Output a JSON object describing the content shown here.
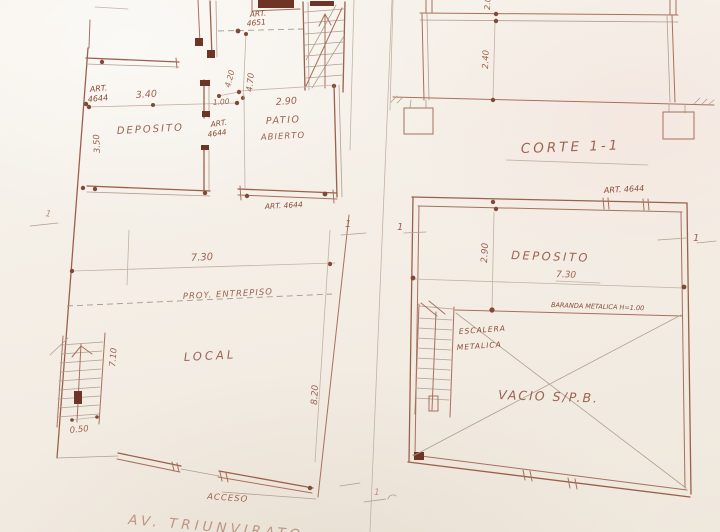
{
  "plan_left": {
    "labels": {
      "art4651_1": "ART.",
      "art4651_2": "4651",
      "art4644a_1": "ART.",
      "art4644a_2": "4644",
      "art4644b_1": "ART.",
      "art4644b_2": "4644",
      "art4644c": "ART. 4644",
      "deposito": "DEPOSITO",
      "patio1": "PATIO",
      "patio2": "ABIERTO",
      "proy": "PROY. ENTREPISO",
      "local": "LOCAL",
      "acceso": "ACCESO",
      "street": "AV. TRIUNVIRATO"
    },
    "dims": {
      "w_deposito": "3.40",
      "h_deposito": "3.50",
      "door": "1.00",
      "w_patio": "2.90",
      "h_patio": "4.70",
      "h_patio2": "4.20",
      "w_planta": "7.30",
      "h_local": "8.20",
      "h_escalera": "7.10",
      "w_escalera": "0.50"
    }
  },
  "section": {
    "title": "CORTE 1-1",
    "h_interior": "2.40",
    "h_top": "2.0"
  },
  "plan_right": {
    "labels": {
      "art4644": "ART. 4644",
      "deposito": "DEPOSITO",
      "baranda": "BARANDA METALICA H=1.00",
      "escalera1": "ESCALERA",
      "escalera2": "METALICA",
      "vacio": "VACIO S/P.B."
    },
    "dims": {
      "h_deposito": "2.90",
      "w_deposito": "7.30"
    }
  },
  "marks": {
    "cut": "1"
  }
}
